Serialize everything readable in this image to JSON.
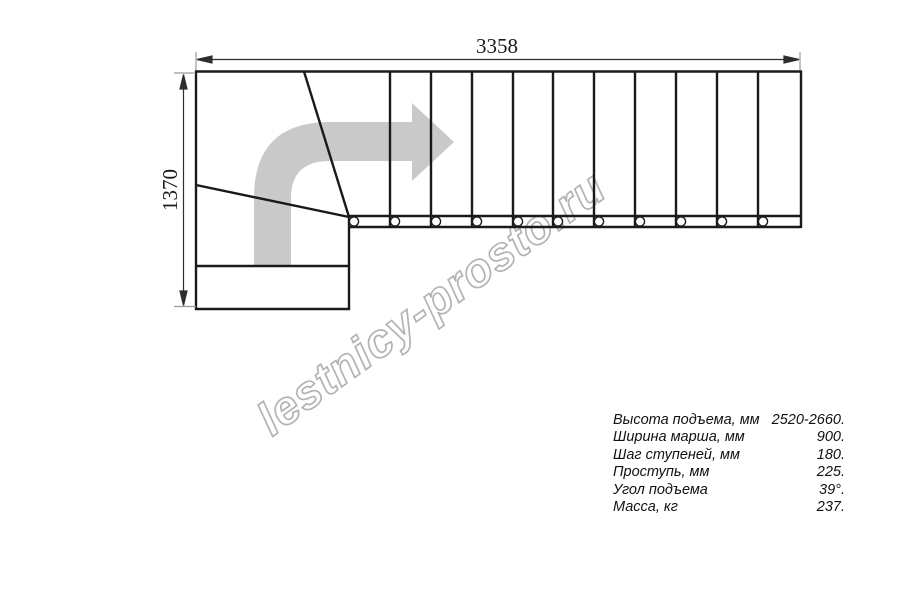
{
  "drawing": {
    "title": "staircase-plan-view",
    "dim_width_label": "3358",
    "dim_height_label": "1370",
    "watermark": "lestnicy-prosto.ru",
    "colors": {
      "line": "#1a1a1a",
      "dimension": "#2e2e2e",
      "extension": "#9a9a9a",
      "arrow_fill": "#c9c9c9",
      "watermark_stroke": "#b3b3b3"
    }
  },
  "specs": {
    "rows": [
      {
        "label": "Высота подъема, мм",
        "value": "2520-2660."
      },
      {
        "label": "Ширина марша, мм",
        "value": "900."
      },
      {
        "label": "Шаг ступеней, мм",
        "value": "180."
      },
      {
        "label": "Проступь, мм",
        "value": "225."
      },
      {
        "label": "Угол подъема",
        "value": "39°."
      },
      {
        "label": "Масса, кг",
        "value": "237."
      }
    ]
  }
}
